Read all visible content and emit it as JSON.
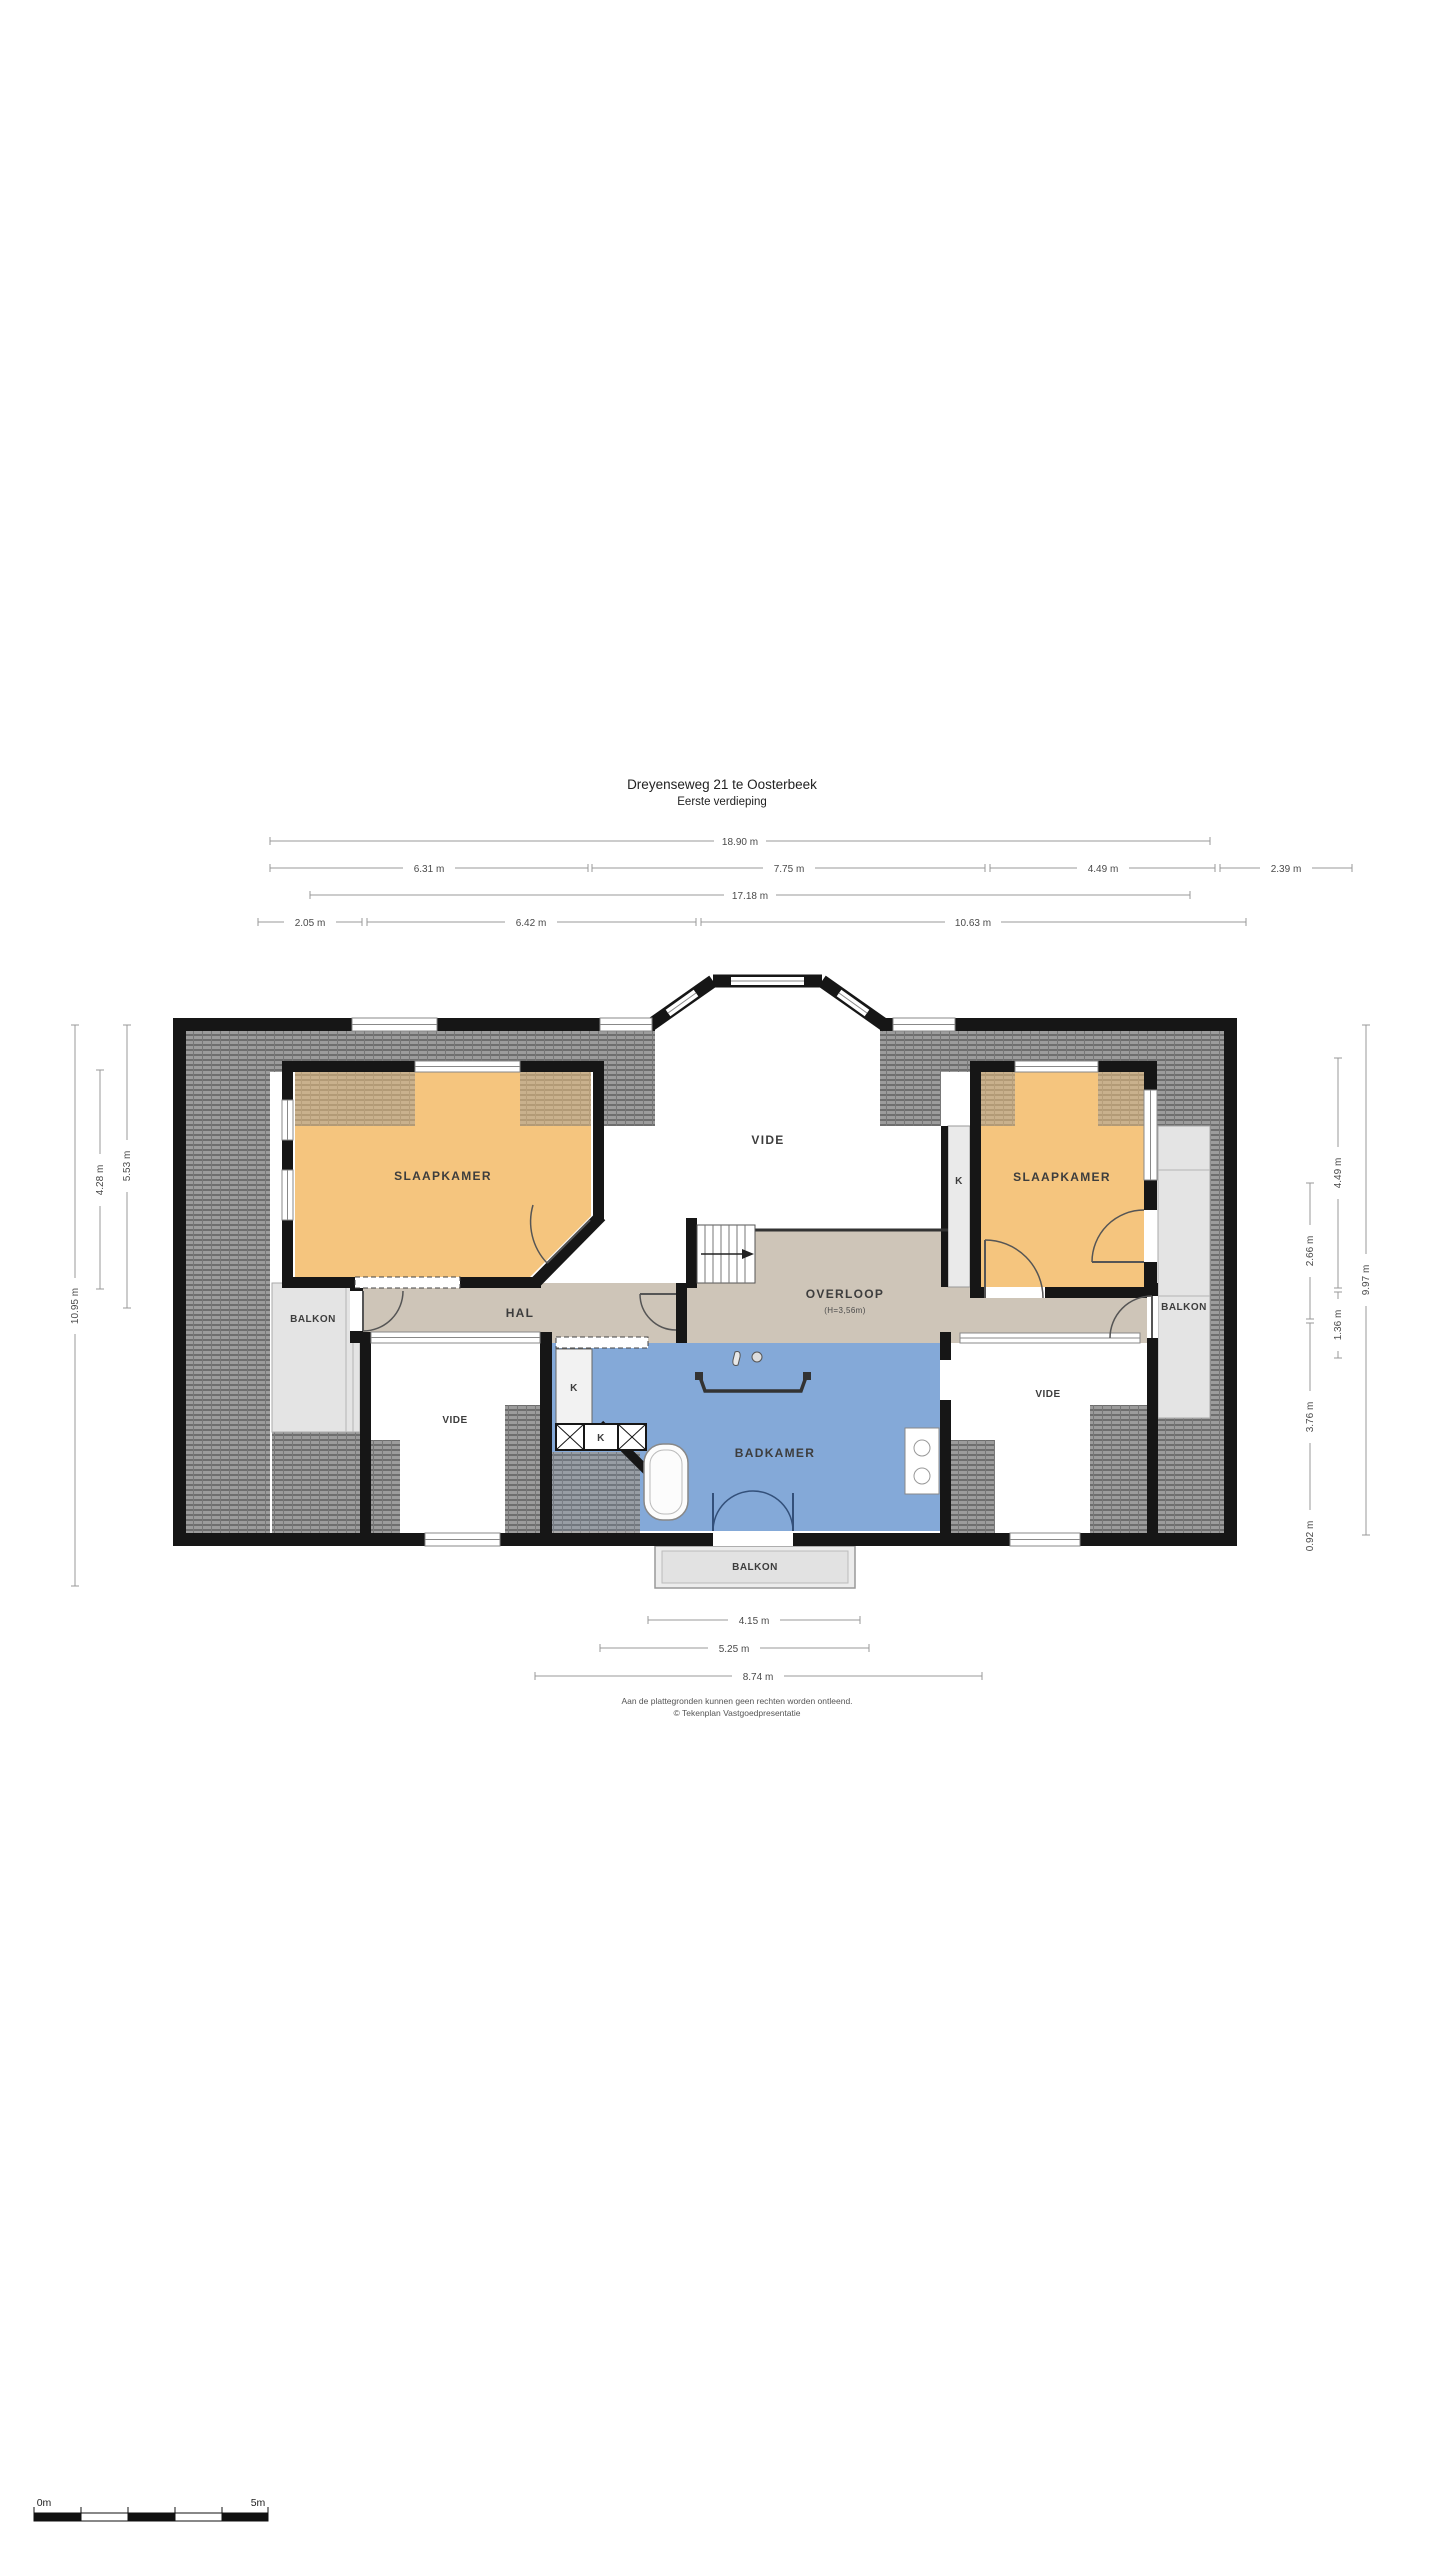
{
  "title": {
    "line1": "Dreyenseweg 21 te Oosterbeek",
    "line2": "Eerste verdieping"
  },
  "dims": {
    "t1": "18.90 m",
    "t2a": "6.31 m",
    "t2b": "7.75 m",
    "t2c": "4.49 m",
    "t2d": "2.39 m",
    "t3": "17.18 m",
    "t4a": "2.05 m",
    "t4b": "6.42 m",
    "t4c": "10.63 m",
    "l1": "5.53 m",
    "l2": "4.28 m",
    "l3": "10.95 m",
    "r1": "2.66 m",
    "r2": "3.76 m",
    "r3": "0.92 m",
    "r4": "4.49 m",
    "r5": "1.36 m",
    "r6": "9.97 m",
    "b1": "4.15 m",
    "b2": "5.25 m",
    "b3": "8.74 m"
  },
  "rooms": {
    "slaapkamer_left": "SLAAPKAMER",
    "slaapkamer_right": "SLAAPKAMER",
    "vide_top": "VIDE",
    "vide_left": "VIDE",
    "vide_right": "VIDE",
    "hal": "HAL",
    "overloop": "OVERLOOP",
    "overloop_height": "(H=3,56m)",
    "badkamer": "BADKAMER",
    "balkon_left": "BALKON",
    "balkon_right": "BALKON",
    "balkon_bottom": "BALKON",
    "k1": "K",
    "k2": "K",
    "k3": "K",
    "k4": "K"
  },
  "colors": {
    "bedroom": "#F5C57E",
    "hall": "#CEC5B8",
    "bathroom": "#84A9D8",
    "balcony": "#E4E4E4",
    "wall": "#161616",
    "roof_hatch": "#9C9C9C"
  },
  "footer": {
    "line1": "Aan de plattegronden kunnen geen rechten worden ontleend.",
    "line2": "© Tekenplan Vastgoedpresentatie"
  },
  "scalebar": {
    "start": "0m",
    "end": "5m"
  }
}
